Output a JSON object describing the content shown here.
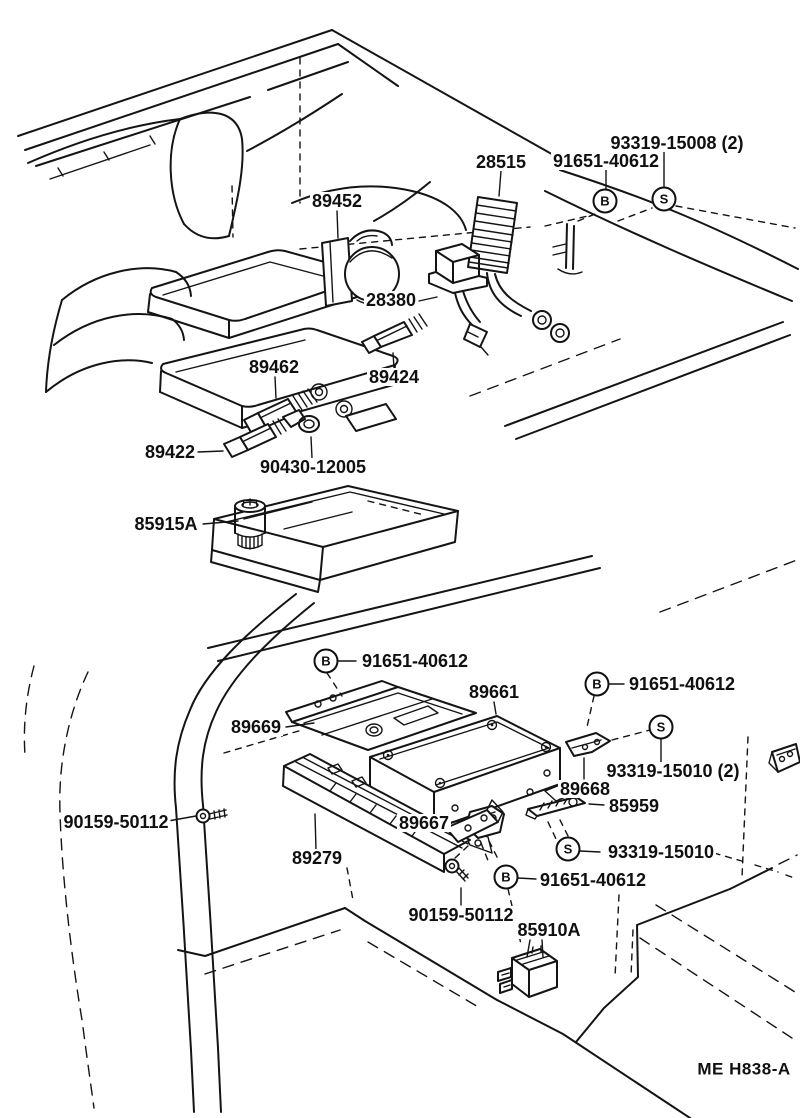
{
  "diagram": {
    "type": "vehicle-parts-diagram",
    "views": [
      {
        "id": "engine-view",
        "description": "engine compartment isometric view"
      },
      {
        "id": "cabin-view",
        "description": "cabin cowl side / ECU mounting isometric view"
      }
    ],
    "colors": {
      "line": "#141414",
      "background": "#ffffff",
      "text": "#101010"
    },
    "labels": [
      {
        "id": "93319-15008",
        "text": "93319-15008 (2)",
        "x": 677,
        "y": 143,
        "view": "engine-view"
      },
      {
        "id": "91651-40612-a",
        "text": "91651-40612",
        "x": 606,
        "y": 161,
        "view": "engine-view"
      },
      {
        "id": "28515",
        "text": "28515",
        "x": 501,
        "y": 162,
        "view": "engine-view"
      },
      {
        "id": "89452",
        "text": "89452",
        "x": 337,
        "y": 201,
        "view": "engine-view"
      },
      {
        "id": "28380",
        "text": "28380",
        "x": 391,
        "y": 300,
        "view": "engine-view"
      },
      {
        "id": "89462",
        "text": "89462",
        "x": 274,
        "y": 367,
        "view": "engine-view"
      },
      {
        "id": "89424",
        "text": "89424",
        "x": 394,
        "y": 377,
        "view": "engine-view"
      },
      {
        "id": "89422",
        "text": "89422",
        "x": 170,
        "y": 452,
        "view": "engine-view"
      },
      {
        "id": "90430-12005",
        "text": "90430-12005",
        "x": 313,
        "y": 467,
        "view": "engine-view"
      },
      {
        "id": "85915A",
        "text": "85915A",
        "x": 166,
        "y": 524,
        "view": "engine-view"
      },
      {
        "id": "91651-40612-b",
        "text": "91651-40612",
        "x": 415,
        "y": 661,
        "view": "cabin-view"
      },
      {
        "id": "89661",
        "text": "89661",
        "x": 494,
        "y": 692,
        "view": "cabin-view"
      },
      {
        "id": "91651-40612-c",
        "text": "91651-40612",
        "x": 682,
        "y": 684,
        "view": "cabin-view"
      },
      {
        "id": "89669",
        "text": "89669",
        "x": 256,
        "y": 727,
        "view": "cabin-view"
      },
      {
        "id": "93319-15010-2",
        "text": "93319-15010 (2)",
        "x": 673,
        "y": 771,
        "view": "cabin-view"
      },
      {
        "id": "89668",
        "text": "89668",
        "x": 585,
        "y": 789,
        "view": "cabin-view"
      },
      {
        "id": "85959",
        "text": "85959",
        "x": 634,
        "y": 806,
        "view": "cabin-view"
      },
      {
        "id": "90159-50112-a",
        "text": "90159-50112",
        "x": 116,
        "y": 822,
        "view": "cabin-view"
      },
      {
        "id": "89667",
        "text": "89667",
        "x": 424,
        "y": 823,
        "view": "cabin-view"
      },
      {
        "id": "93319-15010",
        "text": "93319-15010",
        "x": 661,
        "y": 852,
        "view": "cabin-view"
      },
      {
        "id": "89279",
        "text": "89279",
        "x": 317,
        "y": 858,
        "view": "cabin-view"
      },
      {
        "id": "91651-40612-d",
        "text": "91651-40612",
        "x": 593,
        "y": 880,
        "view": "cabin-view"
      },
      {
        "id": "90159-50112-b",
        "text": "90159-50112",
        "x": 461,
        "y": 915,
        "view": "cabin-view"
      },
      {
        "id": "85910A",
        "text": "85910A",
        "x": 549,
        "y": 930,
        "view": "cabin-view"
      },
      {
        "id": "diagram-code",
        "text": "ME H838-A",
        "x": 744,
        "y": 1069,
        "view": "footer",
        "kind": "code"
      }
    ],
    "fastener_markers": [
      {
        "id": "marker-s-1",
        "letter": "S",
        "x": 664,
        "y": 199,
        "view": "engine-view"
      },
      {
        "id": "marker-b-1",
        "letter": "B",
        "x": 605,
        "y": 201,
        "view": "engine-view"
      },
      {
        "id": "marker-b-2",
        "letter": "B",
        "x": 326,
        "y": 661,
        "view": "cabin-view"
      },
      {
        "id": "marker-b-3",
        "letter": "B",
        "x": 597,
        "y": 684,
        "view": "cabin-view"
      },
      {
        "id": "marker-s-2",
        "letter": "S",
        "x": 661,
        "y": 727,
        "view": "cabin-view"
      },
      {
        "id": "marker-s-3",
        "letter": "S",
        "x": 568,
        "y": 849,
        "view": "cabin-view"
      },
      {
        "id": "marker-b-4",
        "letter": "B",
        "x": 506,
        "y": 877,
        "view": "cabin-view"
      }
    ]
  }
}
